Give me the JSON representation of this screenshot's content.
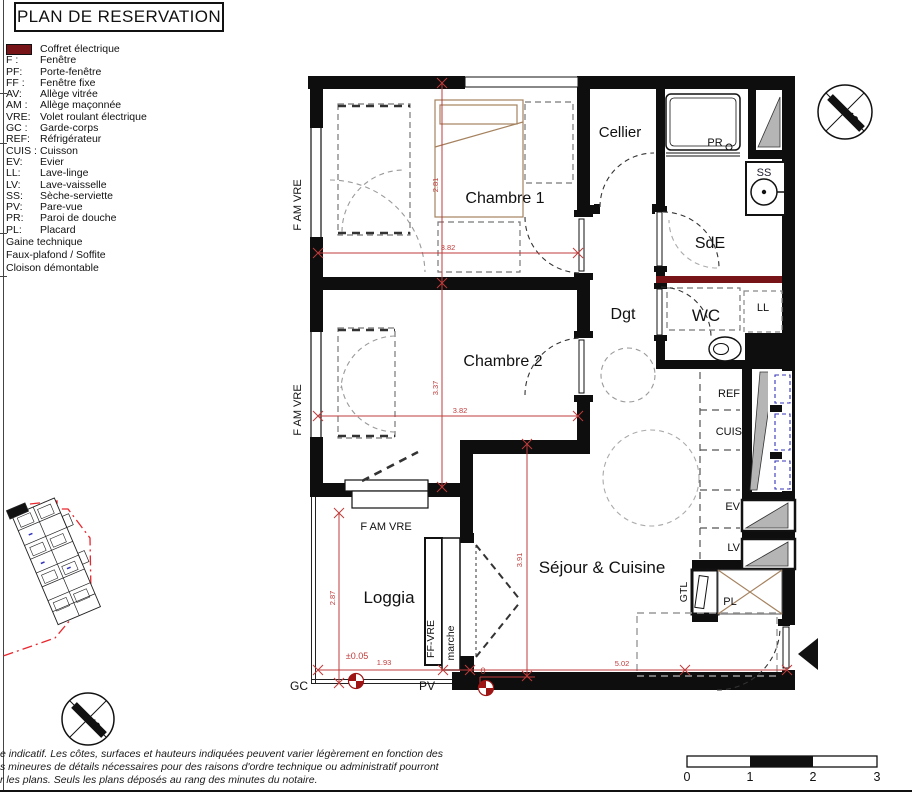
{
  "title": "PLAN DE RESERVATION",
  "legend": {
    "entries": [
      {
        "abbr": "GTL:",
        "label": "Coffret électrique"
      },
      {
        "abbr": "F :",
        "label": "Fenêtre"
      },
      {
        "abbr": "PF:",
        "label": "Porte-fenêtre"
      },
      {
        "abbr": "FF :",
        "label": "Fenêtre fixe"
      },
      {
        "abbr": "AV:",
        "label": "Allège vitrée"
      },
      {
        "abbr": "AM :",
        "label": "Allège maçonnée"
      },
      {
        "abbr": "VRE:",
        "label": "Volet roulant électrique"
      },
      {
        "abbr": "GC :",
        "label": "Garde-corps"
      },
      {
        "abbr": "REF:",
        "label": "Réfrigérateur"
      },
      {
        "abbr": "CUIS :",
        "label": "Cuisson"
      },
      {
        "abbr": "EV:",
        "label": "Evier"
      },
      {
        "abbr": "LL:",
        "label": "Lave-linge"
      },
      {
        "abbr": "LV:",
        "label": "Lave-vaisselle"
      },
      {
        "abbr": "SS:",
        "label": "Sèche-serviette"
      },
      {
        "abbr": "PV:",
        "label": "Pare-vue"
      },
      {
        "abbr": "PR:",
        "label": "Paroi de douche"
      },
      {
        "abbr": "PL:",
        "label": "Placard"
      }
    ],
    "swatches": [
      {
        "name": "gaine-technique",
        "label": "Gaine technique"
      },
      {
        "name": "faux-plafond",
        "label": "Faux-plafond / Soffite"
      },
      {
        "name": "cloison-demontable",
        "label": "Cloison démontable"
      }
    ]
  },
  "plan": {
    "rooms": {
      "chambre1": "Chambre 1",
      "chambre2": "Chambre 2",
      "cellier": "Cellier",
      "sde": "SdE",
      "dgt": "Dgt",
      "wc": "WC",
      "sejour": "Séjour & Cuisine",
      "loggia": "Loggia"
    },
    "fixtures": {
      "pr": "PR",
      "ss": "SS",
      "ll": "LL",
      "ref": "REF",
      "cuis": "CUIS",
      "ev": "EV",
      "lv": "LV",
      "gtl": "GTL",
      "pl": "PL",
      "gc": "GC",
      "pv": "PV",
      "marche": "marche",
      "ff_vre": "FF-VRE",
      "f_am_vre": "F AM VRE"
    },
    "dims": {
      "c1_w": "3.82",
      "c1_h": "2.81",
      "c2_w": "3.82",
      "c2_h": "3.37",
      "sej_w": "5.02",
      "sej_h": "3.91",
      "log_w": "1.93",
      "log_h": "2.87",
      "level_loggia": "±0.05",
      "level_sejour": "0"
    },
    "compass": {
      "south": "S"
    }
  },
  "scalebar": {
    "ticks": [
      "0",
      "1",
      "2",
      "3"
    ]
  },
  "disclaimer": {
    "lines": [
      "e indicatif. Les côtes, surfaces et hauteurs indiquées peuvent varier légèrement en fonction des",
      "s mineures de détails nécessaires pour des raisons d'ordre technique ou administratif pourront",
      "r les plans. Seuls les plans déposés au rang des minutes du notaire."
    ]
  },
  "colors": {
    "dim": "#bf3b3b",
    "cloison": "#761418",
    "gaine": "#b5b5b5",
    "wood": "#a5825f",
    "window_blue": "#3434bb"
  }
}
